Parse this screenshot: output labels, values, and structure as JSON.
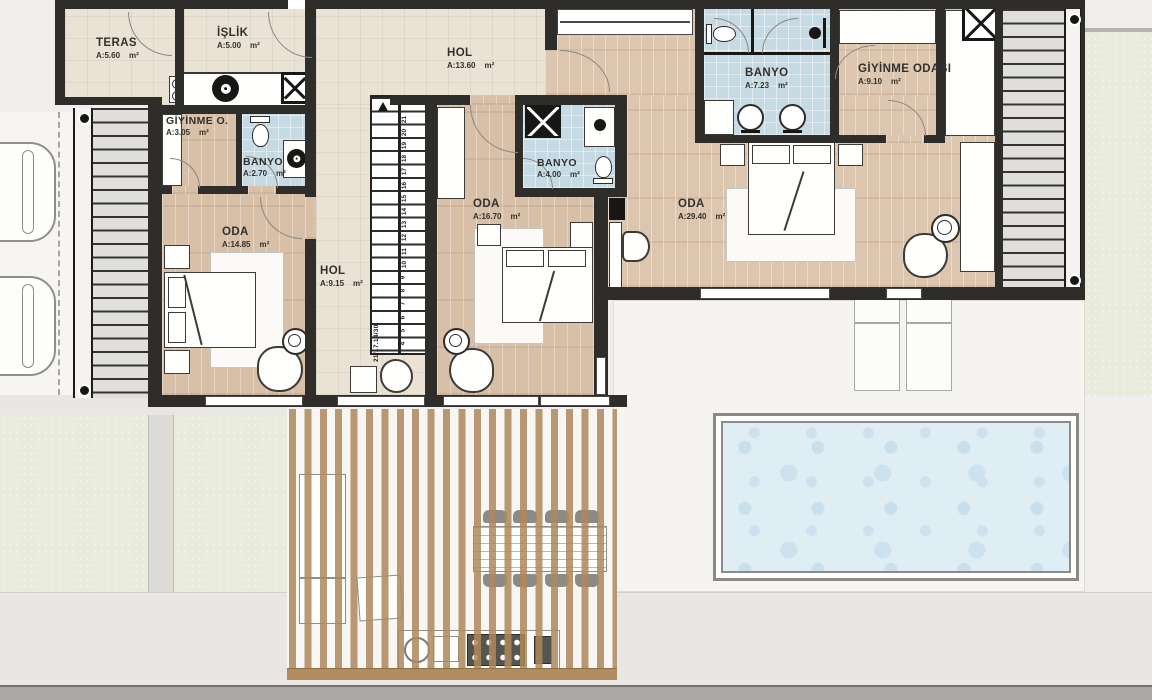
{
  "rooms": {
    "teras": {
      "name": "TERAS",
      "area": "A:5.60",
      "unit": "m²"
    },
    "islik": {
      "name": "İŞLİK",
      "area": "A:5.00",
      "unit": "m²"
    },
    "hol_ust": {
      "name": "HOL",
      "area": "A:13.60",
      "unit": "m²"
    },
    "giyinme_o": {
      "name": "GİYİNME O.",
      "area": "A:3.05",
      "unit": "m²"
    },
    "banyo_kucuk": {
      "name": "BANYO",
      "area": "A:2.70",
      "unit": "m²"
    },
    "oda_sol": {
      "name": "ODA",
      "area": "A:14.85",
      "unit": "m²"
    },
    "hol_orta": {
      "name": "HOL",
      "area": "A:9.15",
      "unit": "m²"
    },
    "oda_orta": {
      "name": "ODA",
      "area": "A:16.70",
      "unit": "m²"
    },
    "banyo_orta": {
      "name": "BANYO",
      "area": "A:4.00",
      "unit": "m²"
    },
    "banyo_ust": {
      "name": "BANYO",
      "area": "A:7.23",
      "unit": "m²"
    },
    "giyinme_odasi": {
      "name": "GİYİNME ODASI",
      "area": "A:9.10",
      "unit": "m²"
    },
    "oda_sag": {
      "name": "ODA",
      "area": "A:29.40",
      "unit": "m²"
    }
  },
  "stairs": {
    "dimension_label": "21/17.14/30",
    "numbers": [
      "4",
      "5",
      "6",
      "7",
      "8",
      "9",
      "10",
      "11",
      "12",
      "13",
      "14",
      "15",
      "16",
      "17",
      "18",
      "19",
      "20",
      "21"
    ]
  },
  "icons": {
    "shaft_x": "diagonal-cross shaft symbol",
    "washing_machine": "ring-and-dot drum symbol",
    "toilet": "oval bowl with tank",
    "sink": "round basin",
    "shower_head": "black disc with bracket"
  },
  "colors": {
    "wall": "#2e2d2a",
    "tile_floor": "#eae3d5",
    "wood_floor": "#d8bfa7",
    "bath_tile": "#c6dae4",
    "pool_water": "#dfedf4",
    "deck_wood": "#b08c5e",
    "grass": "#e9ecdb"
  }
}
